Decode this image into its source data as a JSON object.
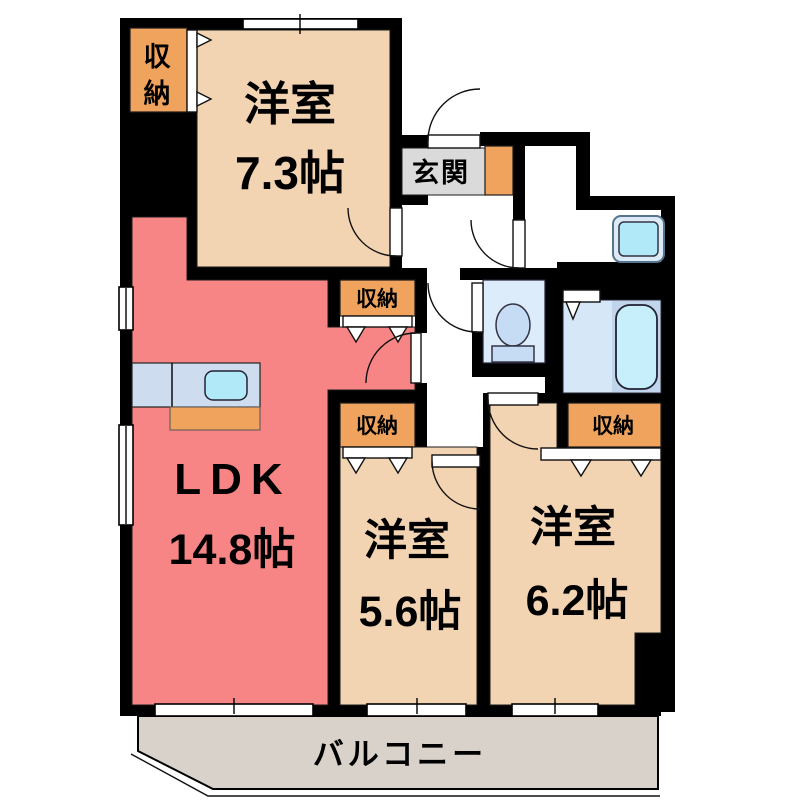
{
  "plan": {
    "type": "apartment-floor-plan",
    "rooms": {
      "western_top": {
        "name": "洋室",
        "size": "7.3帖"
      },
      "ldk": {
        "name": "LDK",
        "size": "14.8帖"
      },
      "western_mid": {
        "name": "洋室",
        "size": "5.6帖"
      },
      "western_right": {
        "name": "洋室",
        "size": "6.2帖"
      }
    },
    "labels": {
      "entrance": "玄関",
      "balcony": "バルコニー",
      "storage": "収納",
      "storage_vertical_top": "収",
      "storage_vertical_bottom": "納"
    },
    "fixtures": [
      "kitchen-counter",
      "kitchen-sink",
      "stove-area",
      "toilet",
      "bathtub",
      "washing-machine-pan"
    ],
    "colors": {
      "wall": "#000000",
      "western_room": "#f2d3b2",
      "ldk": "#f78585",
      "storage": "#efa35c",
      "entrance_floor": "#dadada",
      "balcony": "#d9d2cb",
      "kitchen_counter": "#cedcf0",
      "sink": "#b2e9f8",
      "toilet_room": "#dcecfa",
      "bath_room": "#d6e7f7",
      "bathtub": "#c6eefb",
      "washer_pan": "#b2e9f8"
    }
  }
}
